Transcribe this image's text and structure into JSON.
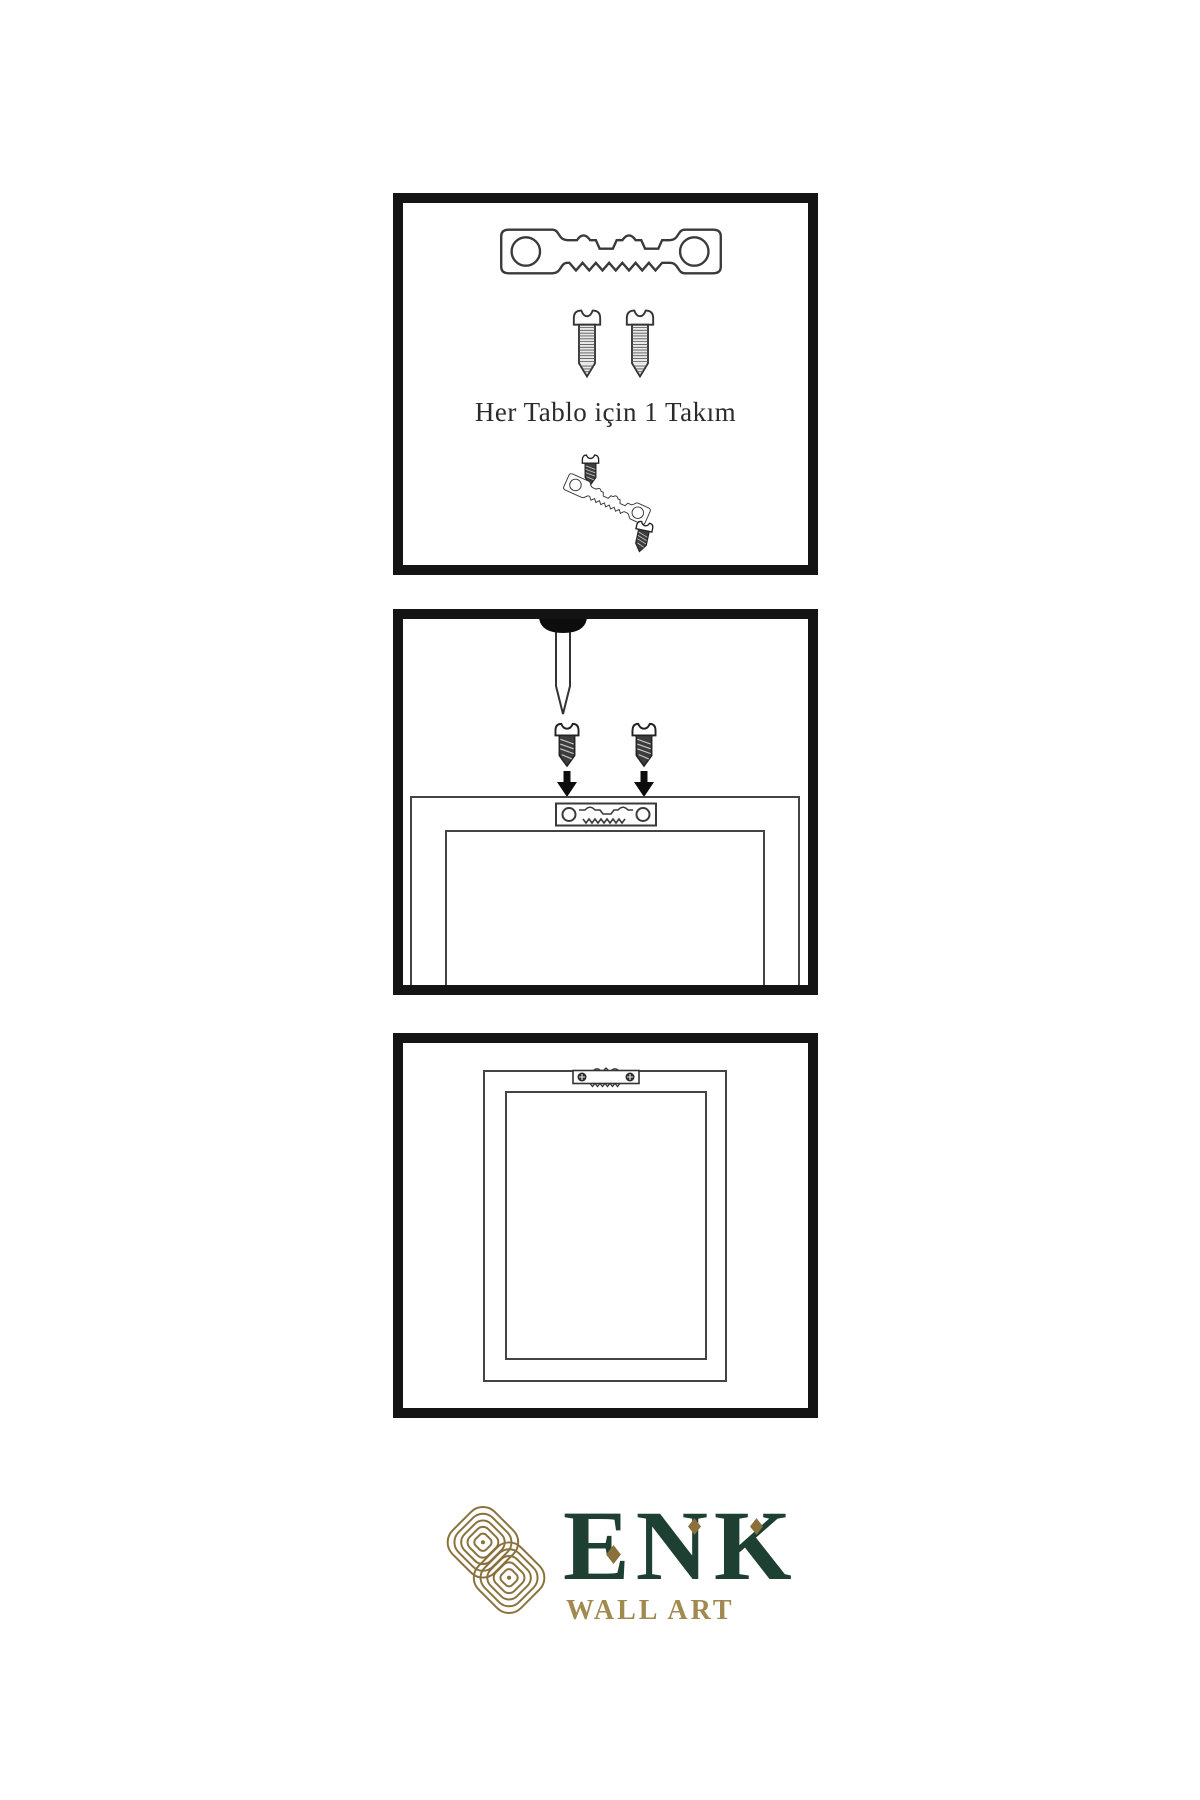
{
  "page": {
    "background": "#ffffff"
  },
  "colors": {
    "panel_border": "#141414",
    "line_art": "#3a3a3a",
    "logo_green": "#1d4033",
    "logo_gold": "#8a713c",
    "tagline_gold": "#a18a50"
  },
  "panels": {
    "kit": {
      "caption": "Her Tablo için 1 Takım",
      "icons": [
        "sawtooth-hanger",
        "screw",
        "screw",
        "screw",
        "tilted-sawtooth-hanger",
        "screw"
      ]
    },
    "install": {
      "icons": [
        "nail",
        "screw",
        "screw",
        "arrow-down",
        "arrow-down",
        "frame-back",
        "sawtooth-hanger-mounted"
      ]
    },
    "hang": {
      "icons": [
        "frame-back",
        "sawtooth-hanger-installed"
      ]
    }
  },
  "logo": {
    "brand": "ENK",
    "tagline": "WALL ART"
  }
}
